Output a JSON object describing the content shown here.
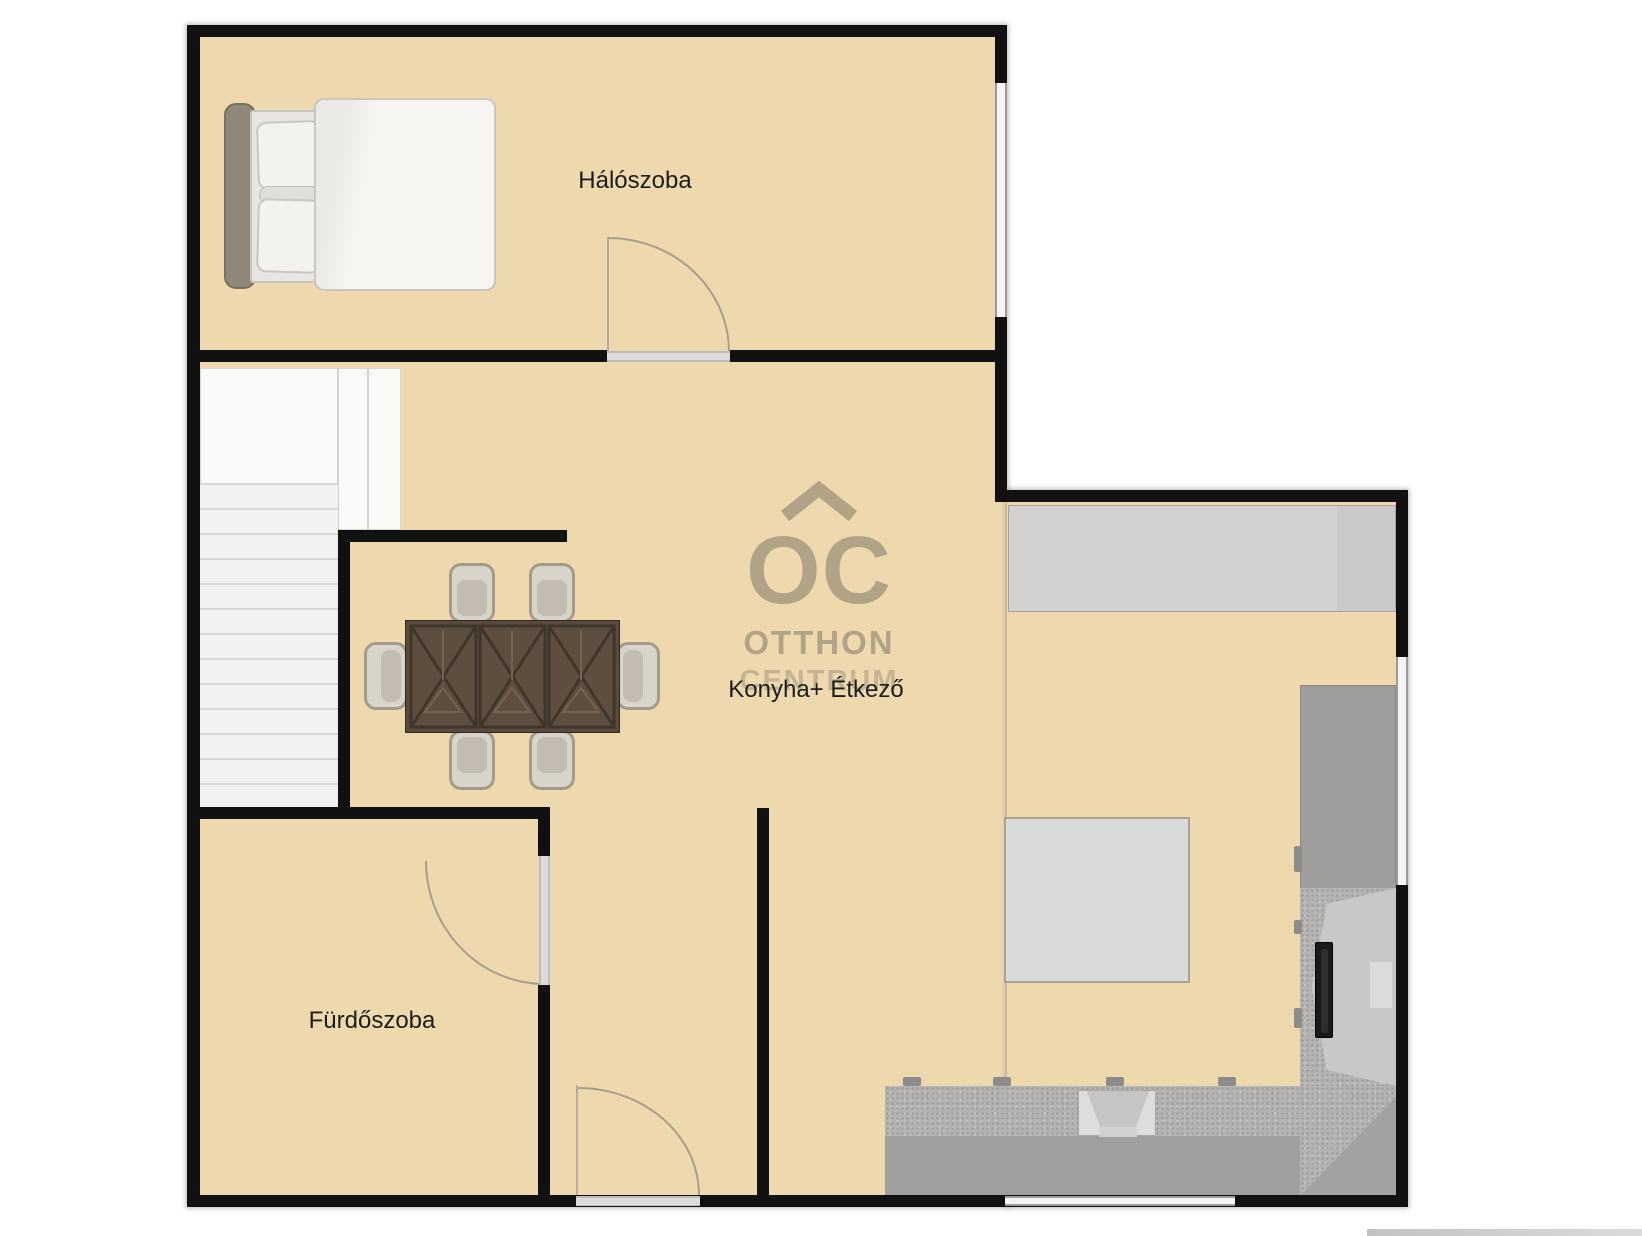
{
  "canvas": {
    "width": 1642,
    "height": 1236,
    "background": "#ffffff"
  },
  "palette": {
    "floor": "#eed9ae",
    "wall": "#111111",
    "counter_light": "#d3d2d0",
    "counter_mid": "#9e9d9b",
    "counter_speckle": "#b4b3b1",
    "stairs": "#f2f1ef",
    "rug": "#d9d9d8",
    "table_wood": "#584a3c",
    "door_arc": "#a89e8e",
    "watermark": "#8a816d",
    "label_text": "#1d1d1d"
  },
  "rooms": {
    "bedroom": {
      "label": "Hálószoba"
    },
    "kitchen_dining": {
      "label": "Konyha+ Étkező"
    },
    "bathroom": {
      "label": "Fürdőszoba"
    }
  },
  "watermark": {
    "letters": "OC",
    "line1": "OTTHON",
    "line2": "CENTRUM"
  },
  "furniture_icons": [
    "double-bed",
    "dining-table",
    "dining-chair",
    "staircase",
    "kitchen-counter",
    "sink",
    "oven",
    "rug",
    "door-swing",
    "window"
  ]
}
